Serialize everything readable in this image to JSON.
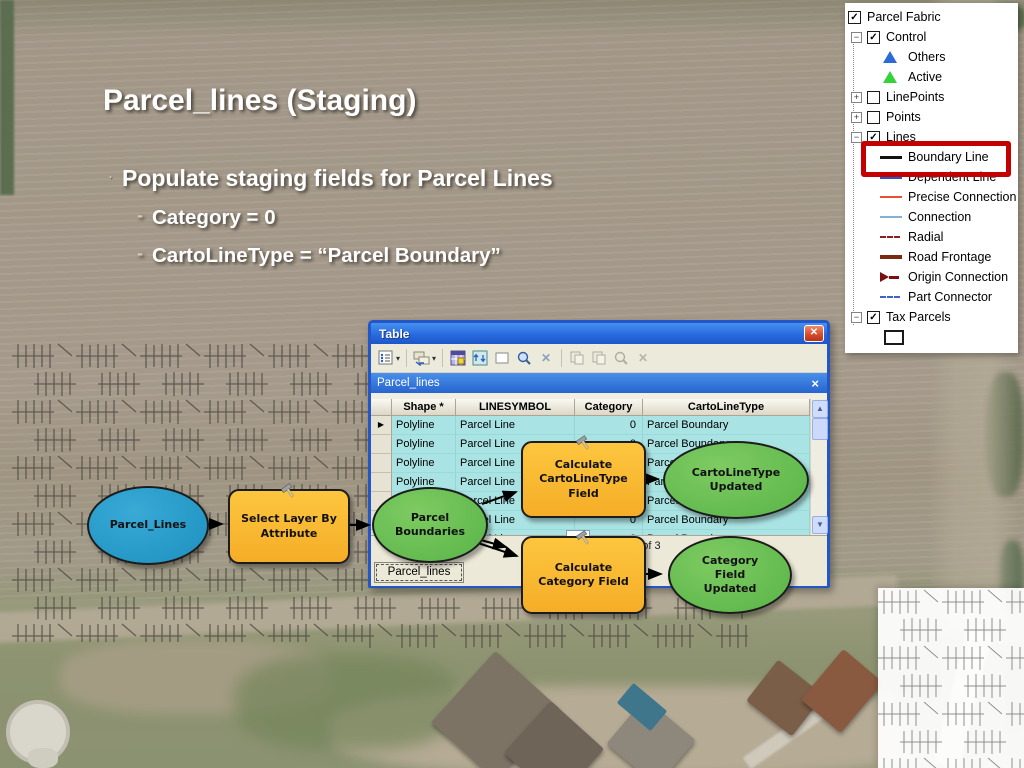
{
  "slide": {
    "title": "Parcel_lines (Staging)",
    "bullet_marker": "·",
    "bullet": "Populate staging fields for Parcel Lines",
    "sub_marker": "-",
    "sub_bullets": [
      "Category = 0",
      "CartoLineType = “Parcel Boundary”"
    ]
  },
  "legend": {
    "glyphs": {
      "check": "✓",
      "plus": "+",
      "minus": "−"
    },
    "items": [
      {
        "label": "Parcel Fabric"
      },
      {
        "label": "Control"
      },
      {
        "label": "Others"
      },
      {
        "label": "Active"
      },
      {
        "label": "LinePoints"
      },
      {
        "label": "Points"
      },
      {
        "label": "Lines"
      },
      {
        "label": "Boundary Line"
      },
      {
        "label": "Dependent Line"
      },
      {
        "label": "Precise Connection"
      },
      {
        "label": "Connection"
      },
      {
        "label": "Radial"
      },
      {
        "label": "Road Frontage"
      },
      {
        "label": "Origin Connection"
      },
      {
        "label": "Part Connector"
      },
      {
        "label": "Tax Parcels"
      },
      {
        "label": ""
      }
    ]
  },
  "table_window": {
    "title": "Table",
    "close_glyph": "✕",
    "tab": "Parcel_lines",
    "tab_close_glyph": "×",
    "bottom_tab": "Parcel_lines",
    "toolbar": {
      "caret": "▾",
      "x_glyph": "✕",
      "icons": [
        "table-options",
        "related-tables",
        "select-by-attributes",
        "switch-selection",
        "clear-selection",
        "zoom-to-selected",
        "delete-selected",
        "copy-disabled",
        "paste-disabled",
        "zoom-disabled",
        "delete-disabled"
      ]
    },
    "columns": [
      "Shape *",
      "LINESYMBOL",
      "Category",
      "CartoLineType"
    ],
    "row_marker": "▶",
    "rows": [
      {
        "shape": "Polyline",
        "linesymbol": "Parcel Line",
        "category": "0",
        "carto": "Parcel Boundary"
      },
      {
        "shape": "Polyline",
        "linesymbol": "Parcel Line",
        "category": "0",
        "carto": "Parcel Boundary"
      },
      {
        "shape": "Polyline",
        "linesymbol": "Parcel Line",
        "category": "0",
        "carto": "Parcel Boundary"
      },
      {
        "shape": "Polyline",
        "linesymbol": "Parcel Line",
        "category": "0",
        "carto": "Parcel Boundary"
      },
      {
        "shape": "Polyline",
        "linesymbol": "Parcel Line",
        "category": "0",
        "carto": "Parcel Boundary"
      },
      {
        "shape": "Polyline",
        "linesymbol": "Parcel Line",
        "category": "0",
        "carto": "Parcel Boundary"
      },
      {
        "shape": "Polyline",
        "linesymbol": "Parcel Line",
        "category": "0",
        "carto": "Parcel Boundary"
      }
    ],
    "record_fragment": "ut of 3",
    "scrollbar": {
      "up": "▲",
      "down": "▼"
    }
  },
  "model": {
    "nodes": {
      "parcel_lines": "Parcel_Lines",
      "select_layer": "Select Layer By Attribute",
      "parcel_boundaries": "Parcel Boundaries",
      "calc_carto": "Calculate CartoLineType Field",
      "carto_updated": "CartoLineType Updated",
      "calc_category": "Calculate Category Field",
      "category_updated": "Category Field Updated"
    }
  },
  "colors": {
    "data_node_blue": "#1d90c0",
    "tool_node_yellow": "#f9b92f",
    "derived_node_green": "#5cb74a",
    "highlight_red": "#c40000",
    "selection_cyan": "#aae3e3",
    "xp_title_blue": "#2a6ade"
  }
}
